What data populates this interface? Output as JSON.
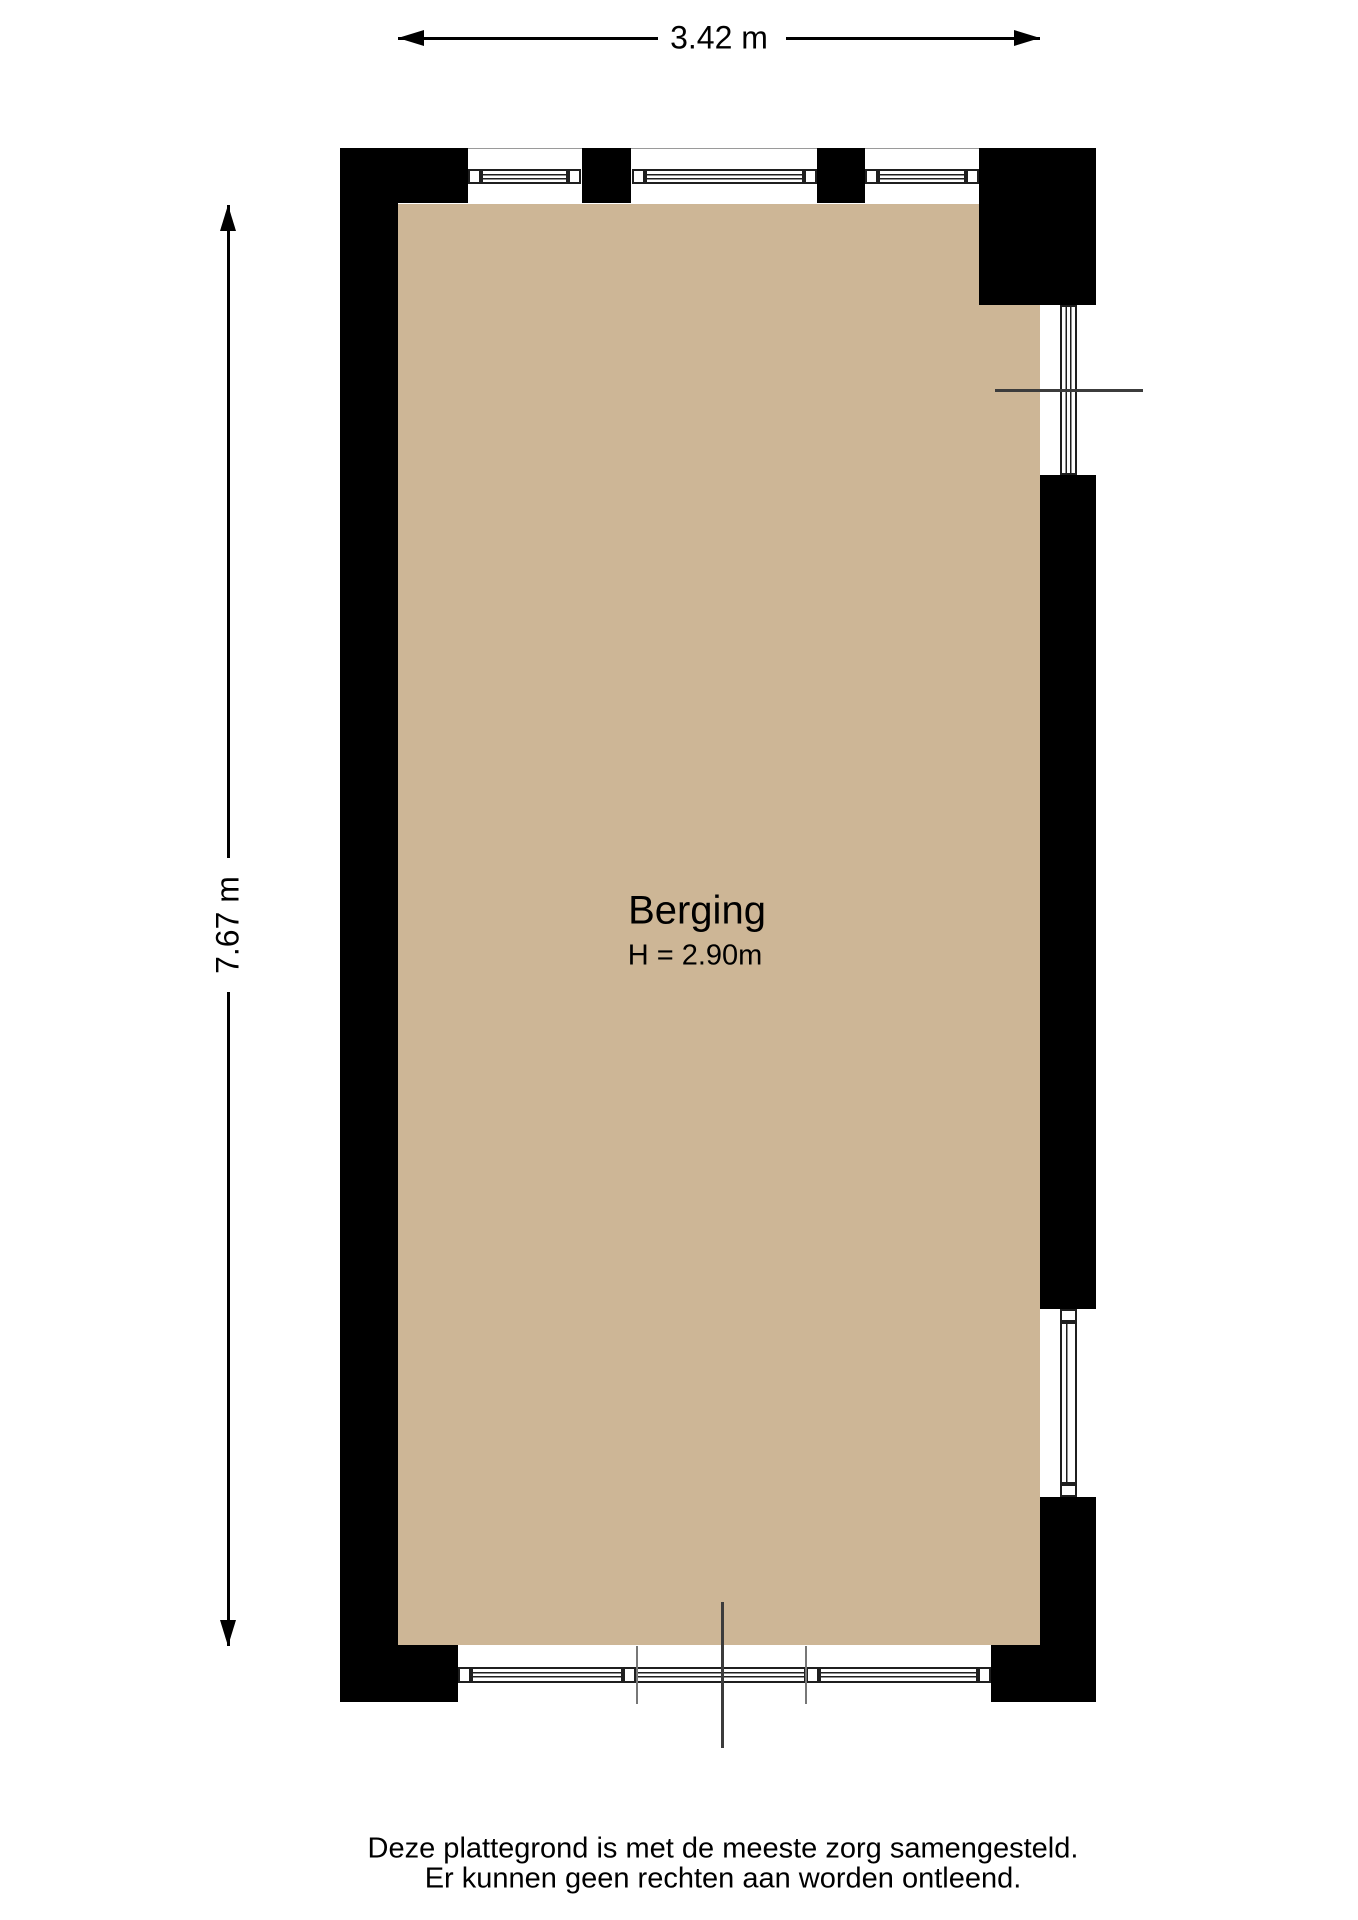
{
  "floorplan": {
    "room": {
      "name": "Berging",
      "ceiling_height": "H = 2.90m"
    },
    "dimensions": {
      "width": "3.42 m",
      "height": "7.67 m"
    },
    "colors": {
      "background": "#ffffff",
      "floor": "#cdb696",
      "wall": "#000000",
      "window_frame": "#1f1f1f",
      "marker_line": "#3c3c3c"
    }
  },
  "footer": {
    "disclaimer_line1": "Deze plattegrond is met de meeste zorg samengesteld.",
    "disclaimer_line2": "Er kunnen geen rechten aan worden ontleend."
  }
}
